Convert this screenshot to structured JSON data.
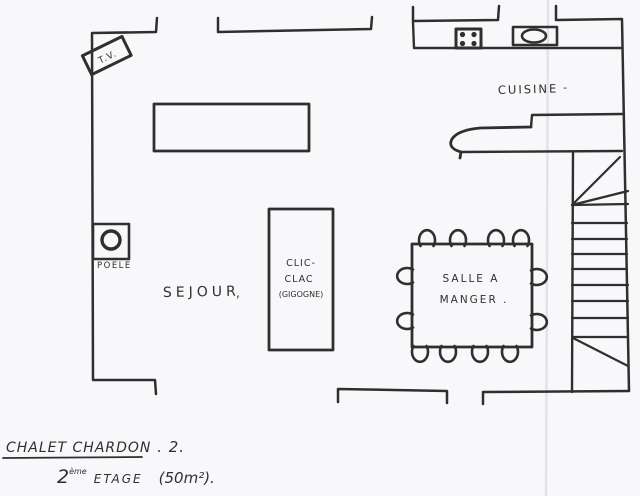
{
  "plan": {
    "colors": {
      "ink": "#2f2f2f",
      "paper": "#f8f8fb"
    },
    "rooms": {
      "sejour": {
        "label": "SEJOUR",
        "mark": ","
      },
      "cuisine": {
        "label": "CUISINE",
        "mark": "-"
      },
      "salle_a_manger": {
        "label_line1": "SALLE A",
        "label_line2": "MANGER ."
      }
    },
    "furniture": {
      "tv": {
        "label": "T.V."
      },
      "poele": {
        "label": "POELE"
      },
      "clic_clac": {
        "line1": "CLIC-",
        "line2": "CLAC",
        "line3": "(GIGOGNE)"
      }
    },
    "title": {
      "name": "CHALET CHARDON",
      "suffix": " .  2.",
      "floor_number": "2",
      "floor_ordinal": "ème",
      "floor_word": "ETAGE",
      "area": "(50m²)."
    }
  }
}
